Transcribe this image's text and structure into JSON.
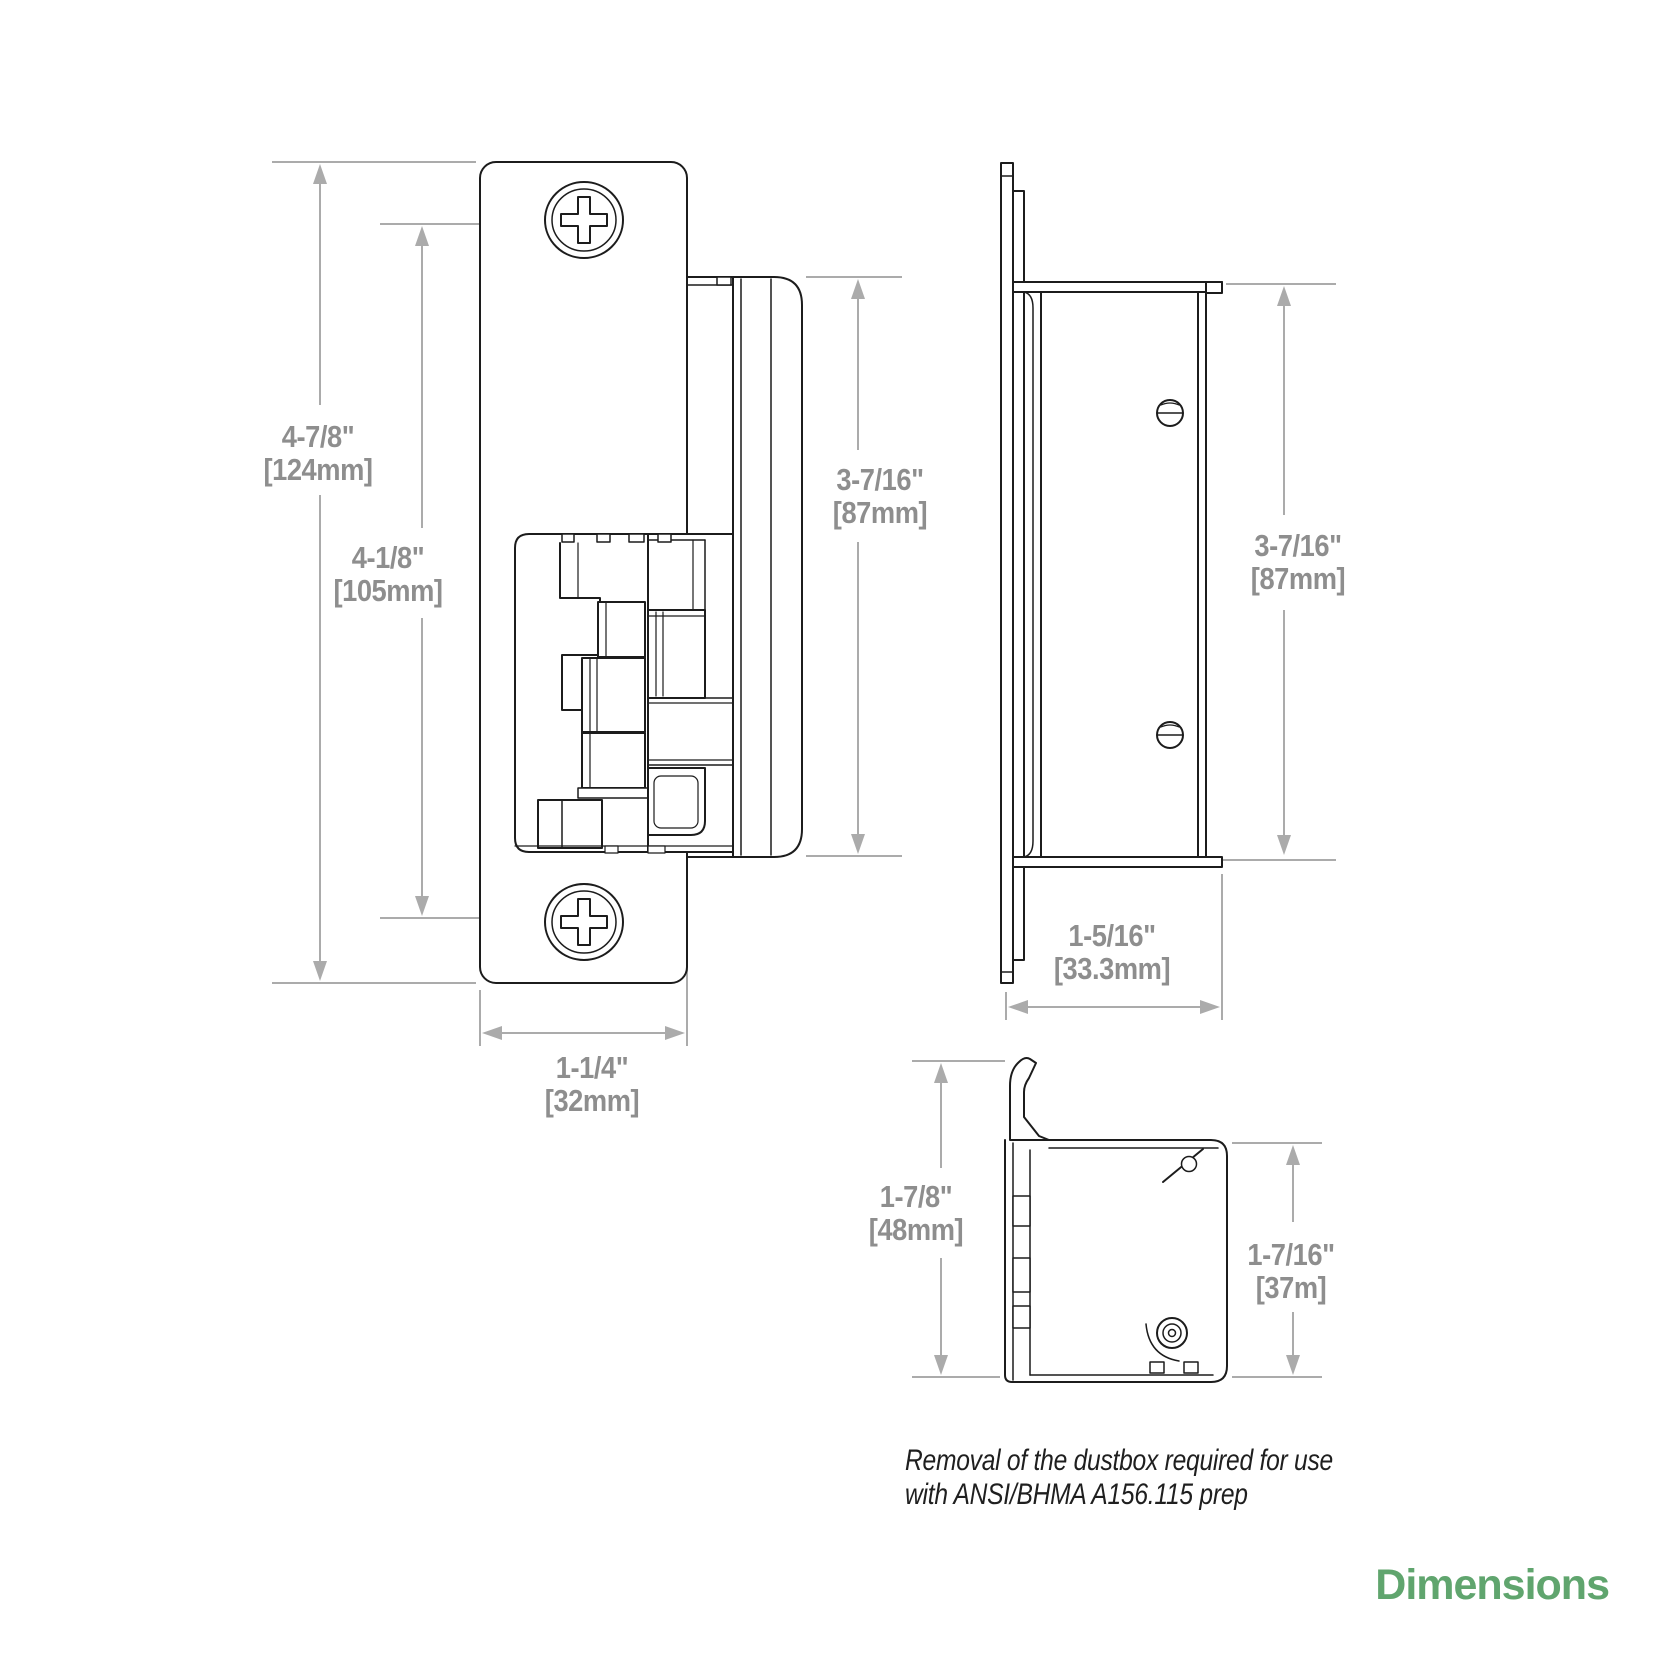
{
  "title": "Dimensions",
  "note": {
    "line1": "Removal of the dustbox required for use",
    "line2": "with ANSI/BHMA A156.115 prep"
  },
  "dimensions": {
    "front_overall_height": {
      "inch": "4-7/8\"",
      "mm": "[124mm]"
    },
    "front_screw_spacing": {
      "inch": "4-1/8\"",
      "mm": "[105mm]"
    },
    "front_body_height": {
      "inch": "3-7/16\"",
      "mm": "[87mm]"
    },
    "front_faceplate_width": {
      "inch": "1-1/4\"",
      "mm": "[32mm]"
    },
    "side_body_height": {
      "inch": "3-7/16\"",
      "mm": "[87mm]"
    },
    "side_depth": {
      "inch": "1-5/16\"",
      "mm": "[33.3mm]"
    },
    "top_overall_depth": {
      "inch": "1-7/8\"",
      "mm": "[48mm]"
    },
    "top_body_depth": {
      "inch": "1-7/16\"",
      "mm": "[37m]"
    }
  },
  "colors": {
    "drawing_line": "#1c1c1c",
    "dimension_line": "#aaaaaa",
    "dimension_text": "#8e8e8e",
    "note_text": "#1f1f1f",
    "accent_green": "#60a56e",
    "background": "#ffffff"
  }
}
